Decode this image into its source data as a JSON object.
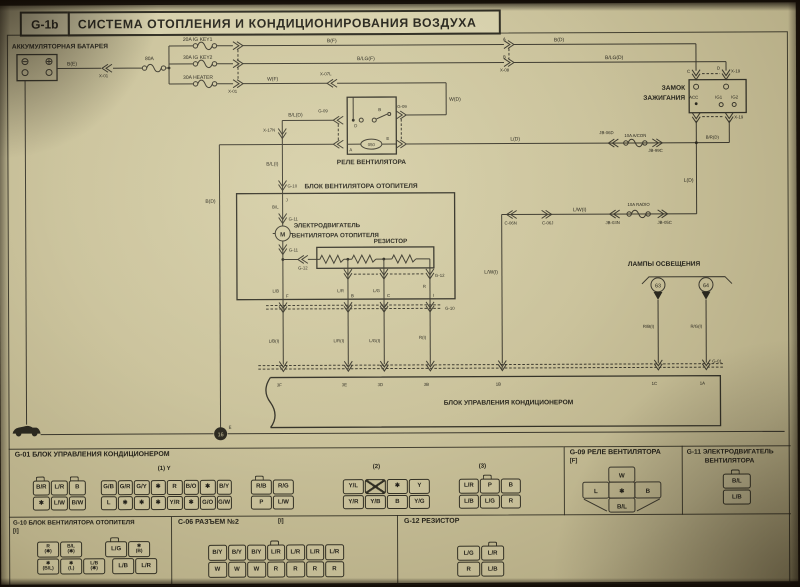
{
  "colors": {
    "paper": "#cac29b",
    "ink": "#24221a",
    "line": "#3b382d"
  },
  "header": {
    "code": "G-1b",
    "title": "СИСТЕМА ОТОПЛЕНИЯ И КОНДИЦИОНИРОВАНИЯ ВОЗДУХА"
  },
  "sch": {
    "battery_title": "АККУМУЛЯТОРНАЯ БАТАРЕЯ",
    "wire_be": "B(E)",
    "conn_x01a": "X-01",
    "fuse_80a": "80A",
    "fuse_igkey1": "20A IG KEY1",
    "fuse_igkey2": "30A IG KEY2",
    "fuse_heater": "30A HEATER",
    "conn_x01b": "X-01",
    "wire_bf": "B(F)",
    "wire_blgf": "B/LG(F)",
    "wire_wf": "W(F)",
    "conn_x07l": "X-07L",
    "pin_a": "A",
    "pin_b": "B",
    "conn_x08": "X-08",
    "wire_bd": "B(D)",
    "wire_blgd": "B/LG(D)",
    "wire_wd": "W(D)",
    "ign_title1": "ЗАМОК",
    "ign_title2": "ЗАЖИГАНИЯ",
    "pin_c": "C",
    "pin_d": "D",
    "conn_x19t": "X-19",
    "conn_x19b": "X-19",
    "pin_acc": "ACC",
    "pin_ig1": "IG1",
    "pin_ig2": "IG2",
    "relay_title": "РЕЛЕ ВЕНТИЛЯТОРА",
    "conn_g09l": "G-09",
    "conn_g09r": "G-09",
    "relay_coil": "050",
    "relay_a": "A",
    "relay_b": "B",
    "relay_d": "D",
    "relay_e": "E",
    "wire_bld": "B/L(D)",
    "conn_x17n": "X-17N",
    "wire_bli": "B/L(I)",
    "conn_g10t": "G-10",
    "fan_title": "БЛОК ВЕНТИЛЯТОРА ОТОПИТЕЛЯ",
    "pin_j": "J",
    "wire_bl": "B/L",
    "conn_g11a": "G-11",
    "conn_g11b": "G-11",
    "motor_m": "M",
    "motor_title1": "ЭЛЕКТРОДВИГАТЕЛЬ",
    "motor_title2": "ВЕНТИЛЯТОРА ОТОПИТЕЛЯ",
    "res_title": "РЕЗИСТОР",
    "conn_g12a": "G-12",
    "conn_g12b": "G-12",
    "wire_lb": "L/B",
    "wire_lr": "L/R",
    "wire_lg": "L/G",
    "wire_r": "R",
    "pin_f": "F",
    "pin_b2": "B",
    "pin_c2": "C",
    "pin_i": "I",
    "conn_g10b": "G-10",
    "wire_lbi": "L/B(I)",
    "wire_lri": "L/R(I)",
    "wire_lgi": "L/G(I)",
    "wire_ri": "R(I)",
    "conn_g01": "G-01",
    "pin_3f": "3F",
    "pin_3e": "3E",
    "pin_3d": "3D",
    "pin_3b": "3B",
    "pin_1b": "1B",
    "pin_1c": "1C",
    "pin_1a": "1A",
    "ctrl_title": "БЛОК УПРАВЛЕНИЯ КОНДИЦИОНЕРОМ",
    "wire_ld1": "L(D)",
    "conn_jb06d": "JB-06D",
    "fuse_acon": "10A A/CON",
    "conn_jb99c": "JB-99C",
    "wire_brd": "B/R(D)",
    "wire_ld2": "L(D)",
    "conn_jb05c": "JB-05C",
    "fuse_radio": "10A RADIO",
    "conn_jb03n": "JB-03N",
    "wire_lwi1": "L/W(I)",
    "conn_c06j": "C-06J",
    "conn_c06n": "C-06N",
    "wire_lwi2": "L/W(I)",
    "lamps_title": "ЛАМПЫ ОСВЕЩЕНИЯ",
    "lamp_63": "63",
    "lamp_64": "64",
    "wire_rbi": "R/B(I)",
    "wire_rgi": "R/G(I)",
    "ground_16": "16",
    "ground_e": "E"
  },
  "sections": {
    "g01": {
      "title": "G-01 БЛОК УПРАВЛЕНИЯ КОНДИЦИОНЕРОМ",
      "tag1": "(1) Y",
      "tag2": "(2)",
      "tag3": "(3)",
      "group1": [
        [
          "B/R",
          "L/R",
          "B"
        ],
        [
          "✱",
          "L/W",
          "B/W"
        ]
      ],
      "group2": [
        [
          "G/B",
          "G/R",
          "G/Y",
          "✱",
          "R",
          "B/O",
          "✱",
          "B/Y"
        ],
        [
          "L",
          "✱",
          "✱",
          "✱",
          "Y/R",
          "✱",
          "G/O",
          "G/W"
        ]
      ],
      "group3": [
        [
          "R/B",
          "R/G"
        ],
        [
          "P",
          "L/W"
        ]
      ],
      "conn2": [
        [
          "Y/L",
          "✕",
          "✱",
          "Y"
        ],
        [
          "Y/R",
          "Y/B",
          "B",
          "Y/G"
        ]
      ],
      "conn3": [
        [
          "L/R",
          "P",
          "B"
        ],
        [
          "L/B",
          "L/G",
          "R"
        ]
      ]
    },
    "g09": {
      "title": "G-09 РЕЛЕ ВЕНТИЛЯТОРА",
      "tag": "[F]",
      "pin_w": "W",
      "pin_l": "L",
      "pin_star": "✱",
      "pin_b": "B",
      "pin_bl": "B/L"
    },
    "g11": {
      "title1": "G-11 ЭЛЕКТРОДВИГАТЕЛЬ",
      "title2": "ВЕНТИЛЯТОРА",
      "rows": [
        [
          "B/L"
        ],
        [
          "L/B"
        ]
      ]
    },
    "g10": {
      "title": "G-10 БЛОК ВЕНТИЛЯТОРА ОТОПИТЕЛЯ",
      "tag": "[I]",
      "a1": [
        [
          [
            "R",
            "(✱)"
          ],
          [
            "B/L",
            "(✱)"
          ]
        ]
      ],
      "a2": [
        [
          [
            "✱",
            "(B/L)"
          ],
          [
            "✱",
            "(L)"
          ],
          [
            "L/B",
            "(✱)"
          ]
        ]
      ],
      "b1": [
        [
          "L/G",
          [
            "✱",
            "(B)"
          ]
        ]
      ],
      "b2": [
        [
          "L/B",
          "L/R"
        ]
      ]
    },
    "c06": {
      "title": "C-06 РАЗЪЕМ №2",
      "tag": "[I]",
      "rows": [
        [
          "B/Y",
          "B/Y",
          "B/Y",
          "L/R",
          "L/R",
          "L/R",
          "L/R"
        ],
        [
          "W",
          "W",
          "W",
          "R",
          "R",
          "R",
          "R"
        ]
      ]
    },
    "g12": {
      "title": "G-12 РЕЗИСТОР",
      "rows": [
        [
          "L/G",
          "L/R"
        ],
        [
          "R",
          "L/B"
        ]
      ]
    }
  }
}
